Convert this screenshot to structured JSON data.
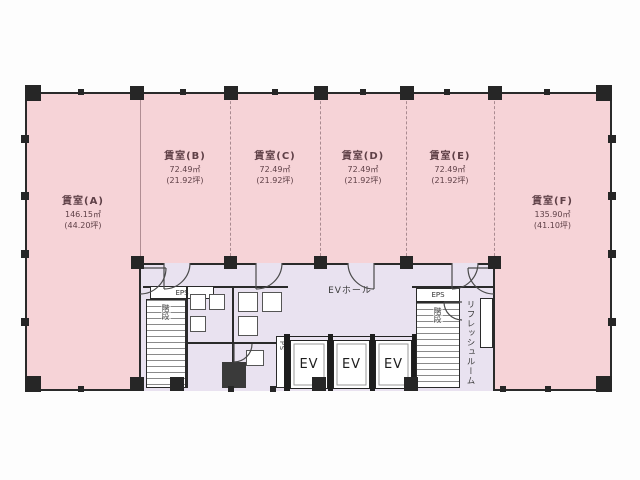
{
  "plan": {
    "rooms": [
      {
        "id": "A",
        "name": "賃室(A)",
        "area_m2": "146.15㎡",
        "area_tsubo": "(44.20坪)"
      },
      {
        "id": "B",
        "name": "賃室(B)",
        "area_m2": "72.49㎡",
        "area_tsubo": "(21.92坪)"
      },
      {
        "id": "C",
        "name": "賃室(C)",
        "area_m2": "72.49㎡",
        "area_tsubo": "(21.92坪)"
      },
      {
        "id": "D",
        "name": "賃室(D)",
        "area_m2": "72.49㎡",
        "area_tsubo": "(21.92坪)"
      },
      {
        "id": "E",
        "name": "賃室(E)",
        "area_m2": "72.49㎡",
        "area_tsubo": "(21.92坪)"
      },
      {
        "id": "F",
        "name": "賃室(F)",
        "area_m2": "135.90㎡",
        "area_tsubo": "(41.10坪)"
      }
    ],
    "core": {
      "ev_hall_label": "EVホール",
      "elevators": [
        "EV",
        "EV",
        "EV"
      ],
      "refresh_room_label": "リフレッシュルーム",
      "left_stair_label": "階段",
      "right_stair_label": "階段",
      "left_eps_label": "EPS",
      "right_eps_label": "EPS",
      "ps_label": "PS"
    },
    "colors": {
      "room_fill": "#f6d3d7",
      "core_fill": "#e9e2f0",
      "wall": "#2a2a2a"
    }
  }
}
